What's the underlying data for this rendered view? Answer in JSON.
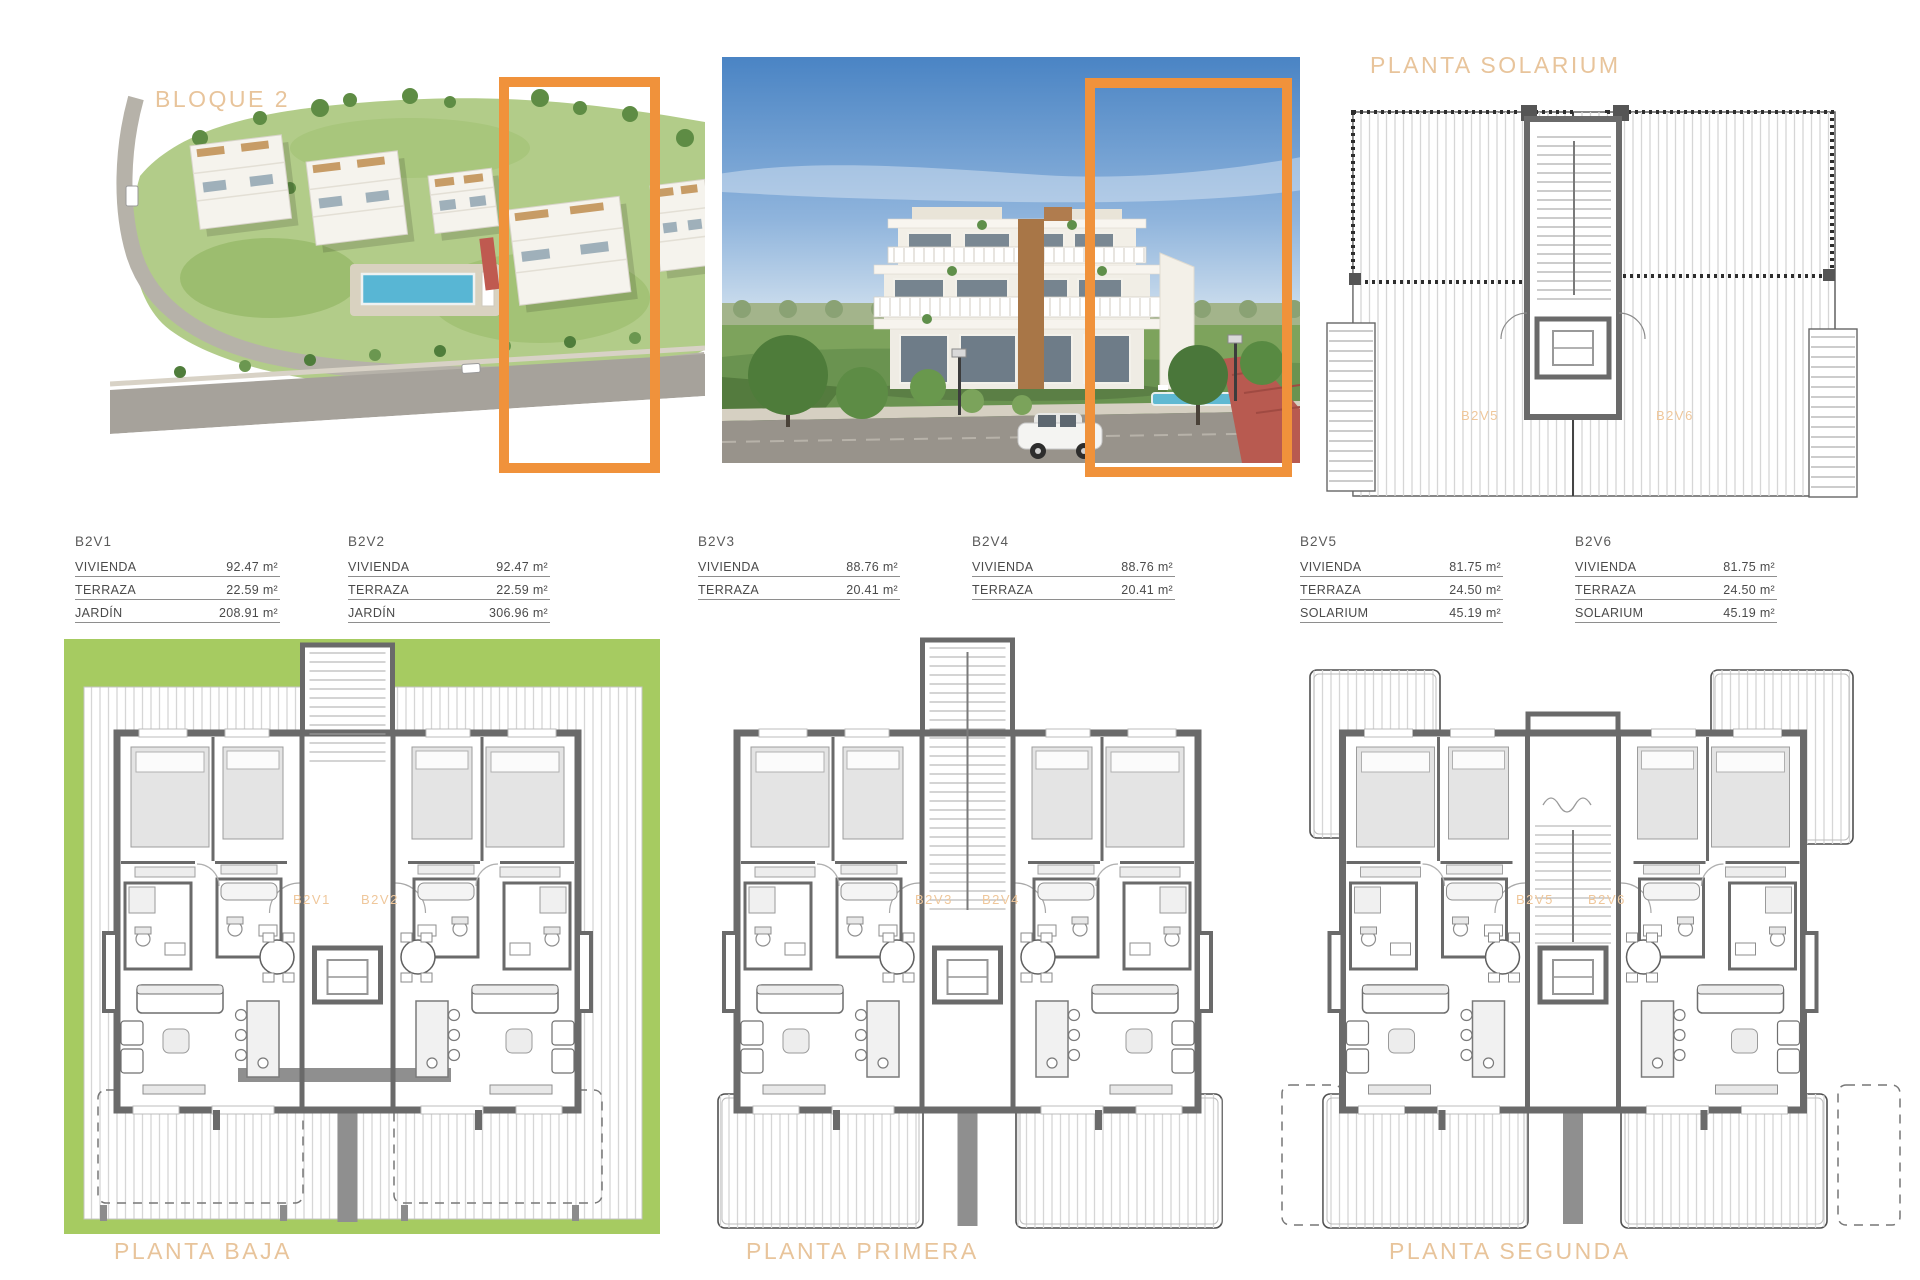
{
  "headings": {
    "bloque": "BLOQUE 2",
    "solarium": "PLANTA SOLARIUM",
    "baja": "PLANTA BAJA",
    "primera": "PLANTA PRIMERA",
    "segunda": "PLANTA SEGUNDA"
  },
  "colors": {
    "accent_orange": "#F0923B",
    "heading_tan": "#E8C49B",
    "unit_label_orange": "#EFC79B",
    "garden_green": "#A6CB61",
    "wall_gray": "#6a6a6a"
  },
  "unit_tables": [
    {
      "unit": "B2V1",
      "rows": [
        {
          "label": "VIVIENDA",
          "value": "92.47 m²"
        },
        {
          "label": "TERRAZA",
          "value": "22.59 m²"
        },
        {
          "label": "JARDÍN",
          "value": "208.91 m²"
        }
      ]
    },
    {
      "unit": "B2V2",
      "rows": [
        {
          "label": "VIVIENDA",
          "value": "92.47 m²"
        },
        {
          "label": "TERRAZA",
          "value": "22.59 m²"
        },
        {
          "label": "JARDÍN",
          "value": "306.96 m²"
        }
      ]
    },
    {
      "unit": "B2V3",
      "rows": [
        {
          "label": "VIVIENDA",
          "value": "88.76 m²"
        },
        {
          "label": "TERRAZA",
          "value": "20.41 m²"
        }
      ]
    },
    {
      "unit": "B2V4",
      "rows": [
        {
          "label": "VIVIENDA",
          "value": "88.76 m²"
        },
        {
          "label": "TERRAZA",
          "value": "20.41 m²"
        }
      ]
    },
    {
      "unit": "B2V5",
      "rows": [
        {
          "label": "VIVIENDA",
          "value": "81.75 m²"
        },
        {
          "label": "TERRAZA",
          "value": "24.50 m²"
        },
        {
          "label": "SOLARIUM",
          "value": "45.19 m²"
        }
      ]
    },
    {
      "unit": "B2V6",
      "rows": [
        {
          "label": "VIVIENDA",
          "value": "81.75 m²"
        },
        {
          "label": "TERRAZA",
          "value": "24.50 m²"
        },
        {
          "label": "SOLARIUM",
          "value": "45.19 m²"
        }
      ]
    }
  ],
  "plan_unit_labels": {
    "baja": [
      "B2V1",
      "B2V2"
    ],
    "primera": [
      "B2V3",
      "B2V4"
    ],
    "segunda": [
      "B2V5",
      "B2V6"
    ],
    "solarium": [
      "B2V5",
      "B2V6"
    ]
  }
}
